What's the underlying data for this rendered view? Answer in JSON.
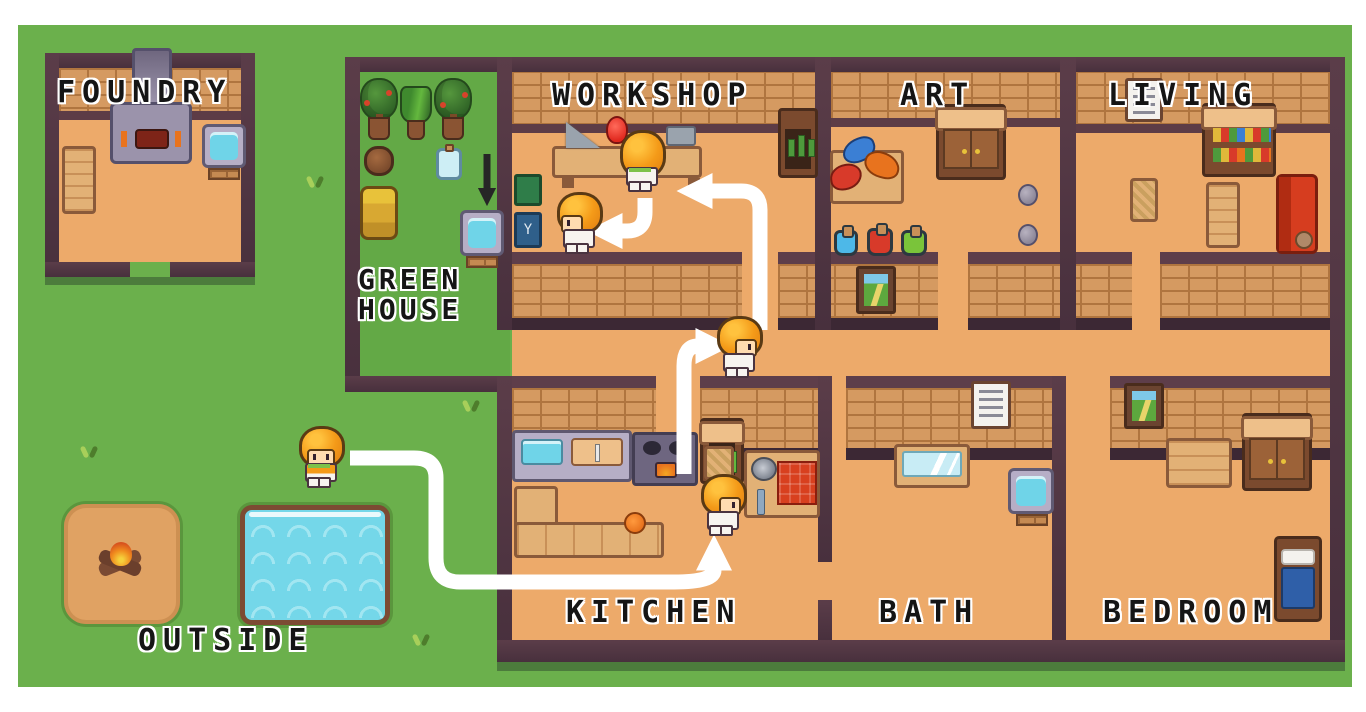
{
  "rooms": [
    {
      "id": "foundry",
      "label": "FOUNDRY"
    },
    {
      "id": "greenhouse",
      "label_line1": "GREEN",
      "label_line2": "HOUSE"
    },
    {
      "id": "workshop",
      "label": "WORKSHOP"
    },
    {
      "id": "art",
      "label": "ART"
    },
    {
      "id": "living",
      "label": "LIVING"
    },
    {
      "id": "kitchen",
      "label": "KITCHEN"
    },
    {
      "id": "bath",
      "label": "BATH"
    },
    {
      "id": "bedroom",
      "label": "BEDROOM"
    },
    {
      "id": "outside",
      "label": "OUTSIDE"
    }
  ],
  "characters": [
    {
      "id": "agent-outside",
      "room": "outside",
      "facing": "down"
    },
    {
      "id": "agent-kitchen",
      "room": "kitchen",
      "facing": "right"
    },
    {
      "id": "agent-hallway",
      "room": "hallway",
      "facing": "right"
    },
    {
      "id": "agent-workbench",
      "room": "workshop",
      "facing": "up"
    },
    {
      "id": "agent-workshop-helper",
      "room": "workshop",
      "facing": "left"
    }
  ],
  "route": {
    "color": "#ffffff",
    "steps": [
      "outside to kitchen",
      "kitchen to hallway",
      "hallway to workshop bench",
      "workshop bench to helper"
    ]
  },
  "greenhouse_arrow": {
    "color": "#262626",
    "points_to": "greenhouse water basin"
  },
  "objects": {
    "foundry": [
      "furnace",
      "water-basin",
      "shelf-cart"
    ],
    "greenhouse": [
      "potted-tree",
      "potted-aloe",
      "potted-tree",
      "clay-pot",
      "glass-jar",
      "planter-barrel",
      "water-basin"
    ],
    "workshop": [
      "workbench",
      "saw",
      "red-bulb",
      "metal-box",
      "green-book",
      "blue-book",
      "bottle-cabinet"
    ],
    "art": [
      "paint-table",
      "wardrobe",
      "potion-blue",
      "potion-red",
      "potion-green",
      "stone",
      "stone"
    ],
    "living": [
      "wall-note",
      "bookshelf",
      "chair",
      "long-table",
      "red-sofa",
      "teddy-bear"
    ],
    "kitchen": [
      "sink-counter",
      "stove",
      "vegetable-cabinet",
      "l-bench",
      "fruit",
      "chair",
      "prep-table",
      "pan",
      "fork",
      "red-cloth"
    ],
    "bath": [
      "wall-note",
      "bathtub",
      "water-basin"
    ],
    "bedroom": [
      "landscape-painting",
      "desk",
      "wardrobe",
      "bed"
    ],
    "outside": [
      "dirt-patch",
      "campfire",
      "pond"
    ],
    "hallway": [
      "landscape-painting"
    ]
  },
  "colors": {
    "grass": "#6bb04c",
    "wall": "#4c323e",
    "brick": "#d59a61",
    "floor": "#edaa6a",
    "water": "#74d7e9",
    "route_path": "#ffffff",
    "label_text": "#151515",
    "page": "#ffffff"
  }
}
